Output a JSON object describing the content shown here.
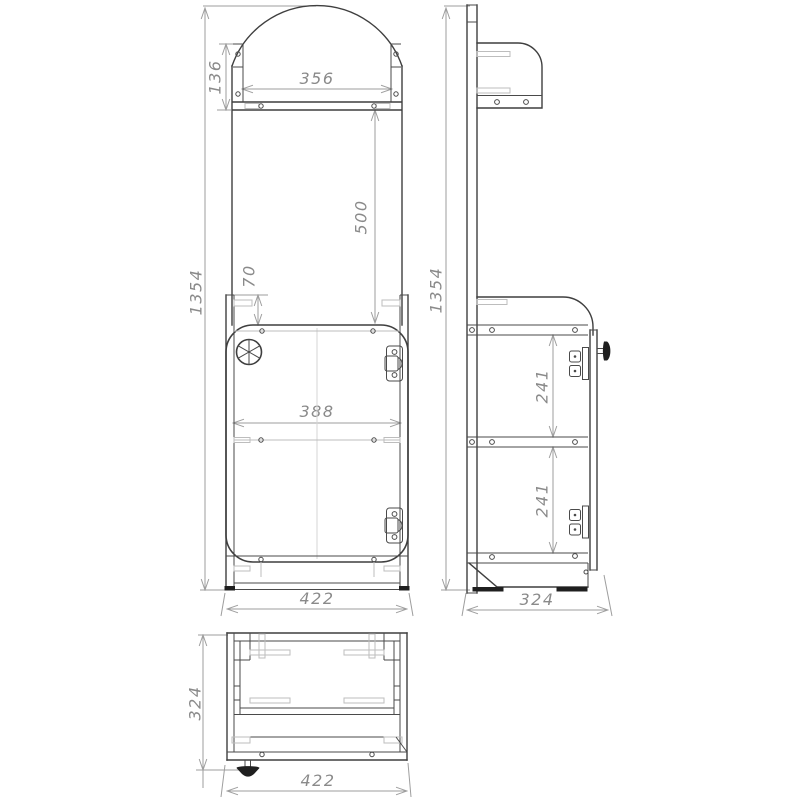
{
  "drawing": {
    "type": "technical-drawing",
    "units": "mm",
    "colors": {
      "background": "#ffffff",
      "outline": "#3f3f3f",
      "dimension_line": "#9e9e9e",
      "dimension_text": "#8a8a8a",
      "detail_light": "#bdbdbd",
      "solid_dark": "#1f1f1f"
    },
    "icons": {
      "lock_wheel": "circled-spoke-wheel",
      "door_knob": "mushroom-knob",
      "hinge": "plate-with-screws",
      "foot": "solid-bar"
    },
    "views": {
      "front": {
        "label": "front view",
        "dims": {
          "overall_height": "1354",
          "bracket_height": "136",
          "shelf_inner_width": "356",
          "shelf_to_cabinet": "500",
          "cabinet_top_offset": "70",
          "inner_width": "388",
          "overall_width": "422"
        }
      },
      "side": {
        "label": "side view",
        "dims": {
          "overall_height": "1354",
          "upper_shelf_spacing": "241",
          "lower_shelf_spacing": "241",
          "overall_depth": "324"
        }
      },
      "bottom": {
        "label": "bottom view",
        "dims": {
          "overall_depth": "324",
          "overall_width": "422"
        }
      }
    }
  }
}
